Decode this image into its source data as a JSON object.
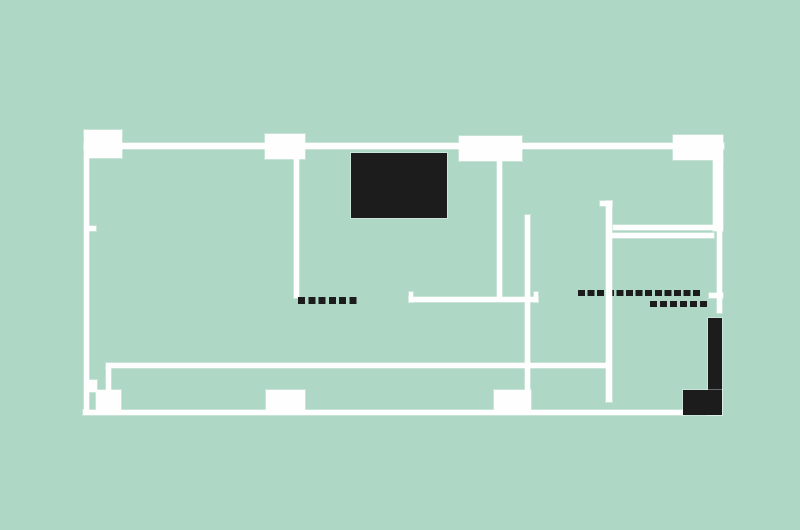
{
  "meta": {
    "title": "floor-plan",
    "canvas": {
      "width": 800,
      "height": 530
    }
  },
  "colors": {
    "background": "#aed7c5",
    "wall": "#fdfefd",
    "dark": "#1c1c1c"
  },
  "shapes": [
    {
      "name": "top-wall",
      "type": "rect",
      "x": 84,
      "y": 143,
      "w": 640,
      "h": 6,
      "color": "wall"
    },
    {
      "name": "column-top-1",
      "type": "rect",
      "x": 84,
      "y": 130,
      "w": 38,
      "h": 28,
      "color": "wall"
    },
    {
      "name": "column-top-2",
      "type": "rect",
      "x": 265,
      "y": 134,
      "w": 40,
      "h": 25,
      "color": "wall"
    },
    {
      "name": "column-top-3",
      "type": "rect",
      "x": 459,
      "y": 136,
      "w": 63,
      "h": 25,
      "color": "wall"
    },
    {
      "name": "column-top-4",
      "type": "rect",
      "x": 673,
      "y": 135,
      "w": 50,
      "h": 25,
      "color": "wall"
    },
    {
      "name": "left-wall",
      "type": "rect",
      "x": 84,
      "y": 158,
      "w": 5,
      "h": 253,
      "color": "wall"
    },
    {
      "name": "left-wall-door-notch",
      "type": "rect",
      "x": 88,
      "y": 226,
      "w": 8,
      "h": 5,
      "color": "wall"
    },
    {
      "name": "interior-wall-a",
      "type": "rect",
      "x": 294,
      "y": 158,
      "w": 5,
      "h": 140,
      "color": "wall"
    },
    {
      "name": "dash-row-left",
      "type": "dashes",
      "x": 298,
      "y": 297,
      "w": 60,
      "h": 7,
      "color": "dark",
      "dash": 7,
      "gap": 3.3
    },
    {
      "name": "dash-row-right-1",
      "type": "dashes",
      "x": 578,
      "y": 290,
      "w": 124,
      "h": 6,
      "color": "dark",
      "dash": 7,
      "gap": 2.6
    },
    {
      "name": "dash-row-right-2",
      "type": "dashes",
      "x": 650,
      "y": 301,
      "w": 57,
      "h": 6,
      "color": "dark",
      "dash": 7,
      "gap": 3
    },
    {
      "name": "interior-wall-b",
      "type": "rect",
      "x": 497,
      "y": 161,
      "w": 5,
      "h": 136,
      "color": "wall"
    },
    {
      "name": "counter-bracket",
      "type": "rect",
      "x": 409,
      "y": 297,
      "w": 129,
      "h": 5,
      "color": "wall"
    },
    {
      "name": "bracket-tick-left",
      "type": "rect",
      "x": 409,
      "y": 292,
      "w": 4,
      "h": 10,
      "color": "wall"
    },
    {
      "name": "bracket-tick-right",
      "type": "rect",
      "x": 534,
      "y": 292,
      "w": 4,
      "h": 10,
      "color": "wall"
    },
    {
      "name": "interior-line-c",
      "type": "rect",
      "x": 525,
      "y": 215,
      "w": 5,
      "h": 175,
      "color": "wall"
    },
    {
      "name": "hook-tick",
      "type": "rect",
      "x": 600,
      "y": 201,
      "w": 12,
      "h": 5,
      "color": "wall"
    },
    {
      "name": "interior-line-d",
      "type": "rect",
      "x": 606,
      "y": 201,
      "w": 6,
      "h": 201,
      "color": "wall"
    },
    {
      "name": "ledge-upper",
      "type": "rect",
      "x": 613,
      "y": 225,
      "w": 101,
      "h": 5,
      "color": "wall"
    },
    {
      "name": "ledge-lower",
      "type": "rect",
      "x": 611,
      "y": 233,
      "w": 103,
      "h": 5,
      "color": "wall"
    },
    {
      "name": "right-wall-upper",
      "type": "rect",
      "x": 713,
      "y": 160,
      "w": 10,
      "h": 71,
      "color": "wall"
    },
    {
      "name": "right-wall-lower",
      "type": "rect",
      "x": 717,
      "y": 231,
      "w": 5,
      "h": 82,
      "color": "wall"
    },
    {
      "name": "right-wall-tick",
      "type": "rect",
      "x": 709,
      "y": 293,
      "w": 14,
      "h": 5,
      "color": "wall"
    },
    {
      "name": "inner-bottom-wall",
      "type": "rect",
      "x": 106,
      "y": 363,
      "w": 505,
      "h": 5,
      "color": "wall"
    },
    {
      "name": "inner-wall-connector",
      "type": "rect",
      "x": 106,
      "y": 368,
      "w": 5,
      "h": 24,
      "color": "wall"
    },
    {
      "name": "left-step-block",
      "type": "rect",
      "x": 88,
      "y": 380,
      "w": 9,
      "h": 12,
      "color": "wall"
    },
    {
      "name": "column-bottom-1",
      "type": "rect",
      "x": 96,
      "y": 390,
      "w": 25,
      "h": 22,
      "color": "wall"
    },
    {
      "name": "column-bottom-2",
      "type": "rect",
      "x": 266,
      "y": 390,
      "w": 39,
      "h": 22,
      "color": "wall"
    },
    {
      "name": "column-bottom-3",
      "type": "rect",
      "x": 494,
      "y": 390,
      "w": 37,
      "h": 20,
      "color": "wall"
    },
    {
      "name": "bottom-wall",
      "type": "rect",
      "x": 83,
      "y": 410,
      "w": 600,
      "h": 5,
      "color": "wall"
    },
    {
      "name": "dark-core-block",
      "type": "rect",
      "x": 351,
      "y": 153,
      "w": 96,
      "h": 65,
      "color": "dark"
    },
    {
      "name": "dark-corner-bar",
      "type": "rect",
      "x": 708,
      "y": 318,
      "w": 14,
      "h": 97,
      "color": "dark"
    },
    {
      "name": "dark-corner-foot",
      "type": "rect",
      "x": 683,
      "y": 390,
      "w": 39,
      "h": 25,
      "color": "dark"
    }
  ]
}
